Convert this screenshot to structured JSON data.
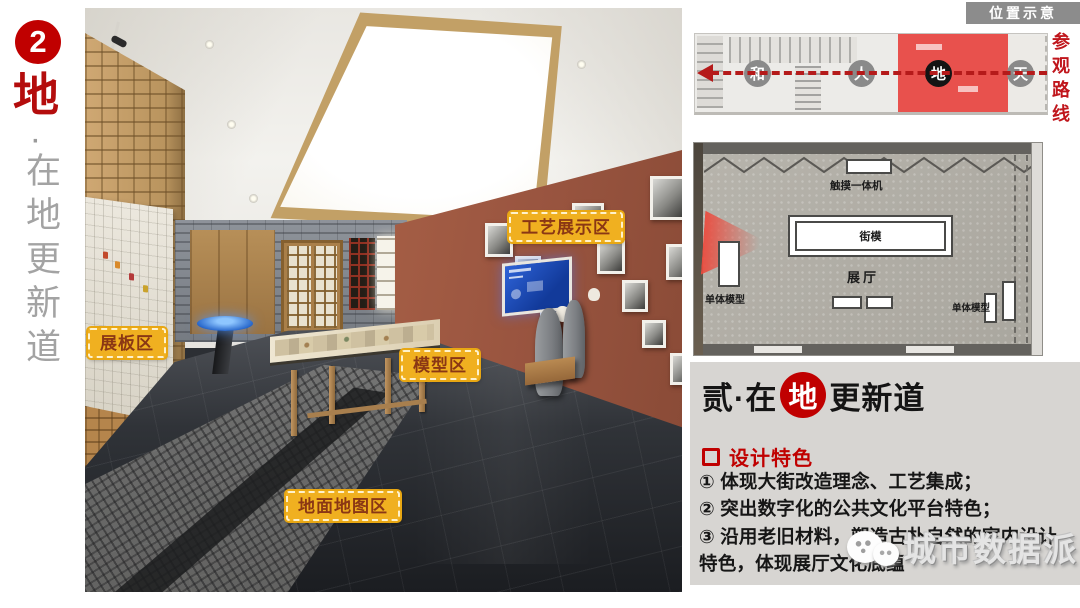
{
  "sidebar": {
    "number": "2",
    "char": "地",
    "dot": "·",
    "subtitle": "在地更新道"
  },
  "photo_labels": {
    "craft": "工艺展示区",
    "board": "展板区",
    "model": "模型区",
    "floor_map": "地面地图区"
  },
  "location": {
    "badge": "位置示意",
    "route": "参观路线",
    "stations": [
      "和",
      "人",
      "地",
      "天"
    ],
    "active_station": "地"
  },
  "floor_plan": {
    "touch_machine": "触摸一体机",
    "street_model": "街模",
    "hall": "展厅",
    "unit_model_left": "单体模型",
    "unit_model_right": "单体模型"
  },
  "panel": {
    "title_prefix": "贰·在",
    "title_circle": "地",
    "title_suffix": "更新道",
    "section_title": "设计特色",
    "items": [
      "① 体现大街改造理念、工艺集成；",
      "② 突出数字化的公共文化平台特色；",
      "③ 沿用老旧材料，塑造古朴自然的室内设计特色，体现展厅文化底蕴"
    ]
  },
  "watermark": {
    "text": "城市数据派"
  },
  "colors": {
    "accent_red": "#c00000",
    "label_bg": "#f0b020",
    "label_text": "#8a3714",
    "plan_highlight": "#e8514d"
  }
}
